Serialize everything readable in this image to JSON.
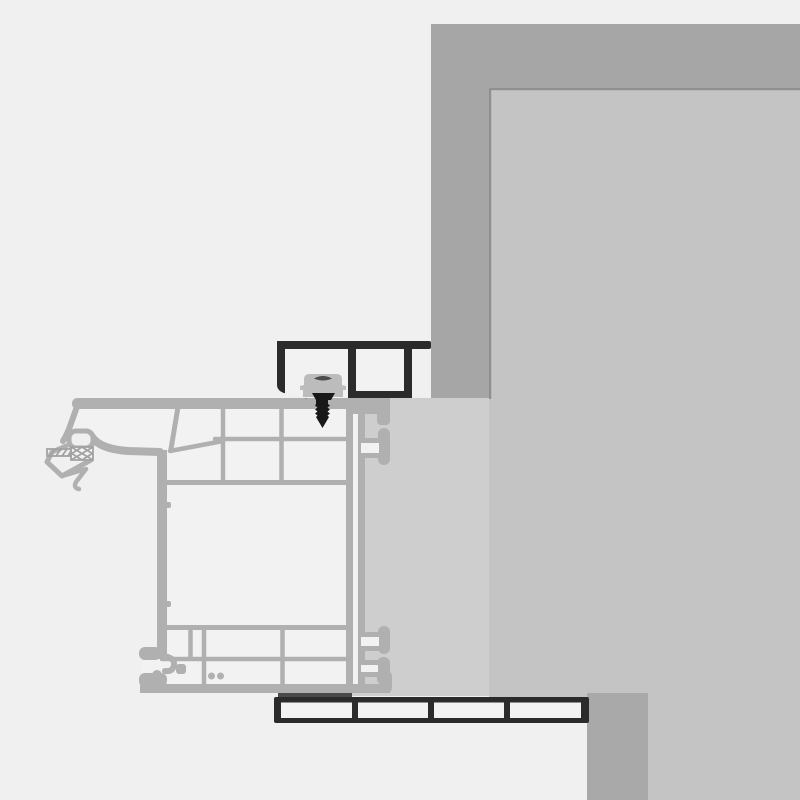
{
  "meta": {
    "title": "Window frame installation cross-section technical drawing",
    "canvas": {
      "width": 800,
      "height": 800
    },
    "visible_text": []
  },
  "colors": {
    "background": "#f0f0f0",
    "masonry": "#a6a6a6",
    "reveal": "#c4c4c4",
    "reveal_edge": "#8f8f8f",
    "plaster": "#cecece",
    "column": "#a9a9a9",
    "frame": "#b0b0b0",
    "chamber": "#f2f2f2",
    "dark_profile": "#2b2b2b",
    "clip": "#bcbcbc",
    "clip_mark": "#4c4c4c",
    "screw": "#181818",
    "gasket_line": "#a2a2a2",
    "shadow_strip": "#4a4a4a"
  },
  "components": {
    "masonry_wall": "L-shaped outer wall band, top right",
    "wall_reveal": "inner wall face with thin edge line",
    "plaster_layer": "plaster strip between frame and wall reveal",
    "shutter_rail": "dark hollow two-chamber guide rail on frame head",
    "mounting_clip": "gray fixing clip block under rail",
    "fixing_screw": "countersunk screw driven into frame",
    "window_frame": "gray multi-chamber frame profile with gaskets, anchor lugs and foot",
    "window_sill": "dark four-chamber sill profile",
    "sill_support": "wall block under sill, bottom right"
  }
}
